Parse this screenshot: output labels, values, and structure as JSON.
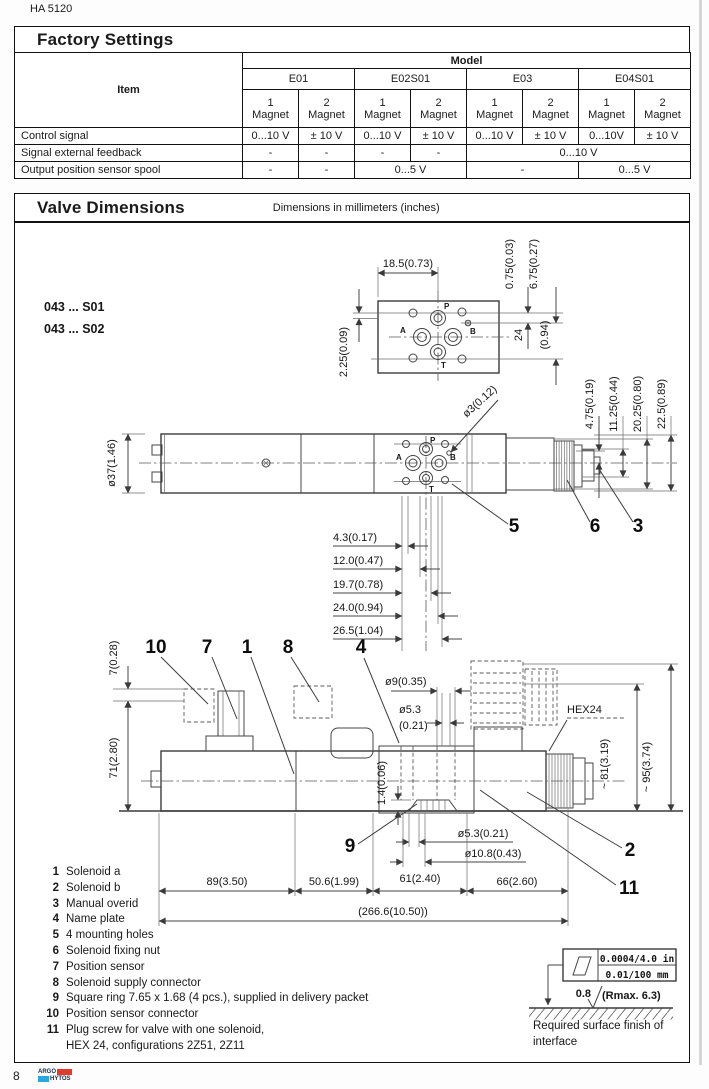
{
  "doc": {
    "code": "HA 5120",
    "page": "8",
    "logo_top": "ARGO",
    "logo_bottom": "HYTOS"
  },
  "factory": {
    "title": "Factory Settings",
    "item": "Item",
    "model": "Model",
    "models": [
      "E01",
      "E02S01",
      "E03",
      "E04S01"
    ],
    "mag1": "1",
    "mag2": "2",
    "magnet": "Magnet",
    "rows": [
      {
        "label": "Control signal",
        "cells": [
          "0...10 V",
          "± 10 V",
          "0...10 V",
          "± 10 V",
          "0...10 V",
          "± 10 V",
          "0...10V",
          "± 10 V"
        ]
      },
      {
        "label": "Signal external feedback",
        "cells": [
          "-",
          "-",
          "-",
          "-",
          "0...10 V"
        ]
      },
      {
        "label": "Output position sensor spool",
        "cells": [
          "-",
          "-",
          "0...5 V",
          "-",
          "0...5 V"
        ]
      }
    ]
  },
  "valve": {
    "title": "Valve Dimensions",
    "subtitle": "Dimensions in millimeters (inches)",
    "variants": [
      "043 ... S01",
      "043 ... S02"
    ],
    "ports": {
      "p": "P",
      "a": "A",
      "b": "B",
      "t": "T"
    },
    "dims": {
      "w185": "18.5(0.73)",
      "h225": "2.25(0.09)",
      "h075": "0.75(0.03)",
      "h675": "6.75(0.27)",
      "h24": "24",
      "h24in": "(0.94)",
      "d37": "ø37(1.46)",
      "d3": "ø3(0.12)",
      "v475": "4.75(0.19)",
      "v1125": "11.25(0.44)",
      "v2025": "20.25(0.80)",
      "v225": "22.5(0.89)",
      "h43": "4.3(0.17)",
      "h12": "12.0(0.47)",
      "h197": "19.7(0.78)",
      "h240": "24.0(0.94)",
      "h265": "26.5(1.04)",
      "v7": "7(0.28)",
      "v71": "71(2.80)",
      "d9": "ø9(0.35)",
      "d53a": "ø5.3",
      "d53b": "(0.21)",
      "hex": "HEX24",
      "v81": "~ 81(3.19)",
      "v95": "~ 95(3.74)",
      "v14": "1.4(0.06)",
      "d53": "ø5.3(0.21)",
      "d108": "ø10.8(0.43)",
      "w89": "89(3.50)",
      "w506": "50.6(1.99)",
      "w61": "61(2.40)",
      "w66": "66(2.60)",
      "wtotal": "(266.6(10.50))"
    },
    "callouts": {
      "c1": "1",
      "c2": "2",
      "c3": "3",
      "c4": "4",
      "c5": "5",
      "c6": "6",
      "c7": "7",
      "c8": "8",
      "c9": "9",
      "c10": "10",
      "c11": "11"
    },
    "legend": [
      {
        "num": "1",
        "text": "Solenoid a"
      },
      {
        "num": "2",
        "text": "Solenoid b"
      },
      {
        "num": "3",
        "text": "Manual overid"
      },
      {
        "num": "4",
        "text": "Name plate"
      },
      {
        "num": "5",
        "text": "4 mounting holes"
      },
      {
        "num": "6",
        "text": "Solenoid fixing nut"
      },
      {
        "num": "7",
        "text": "Position sensor"
      },
      {
        "num": "8",
        "text": "Solenoid supply connector"
      },
      {
        "num": "9",
        "text": "Square ring 7.65 x 1.68 (4 pcs.), supplied in delivery packet"
      },
      {
        "num": "10",
        "text": "Position sensor connector"
      },
      {
        "num": "11",
        "text": "Plug screw for valve with one solenoid,"
      },
      {
        "num": "",
        "text": "HEX 24, configurations 2Z51, 2Z11"
      }
    ],
    "surface": {
      "in": "0.0004/4.0 in",
      "mm": "0.01/100 mm",
      "ra": "0.8",
      "rmax": "(Rmax.  6.3)",
      "caption1": "Required surface finish of",
      "caption2": "interface"
    }
  }
}
